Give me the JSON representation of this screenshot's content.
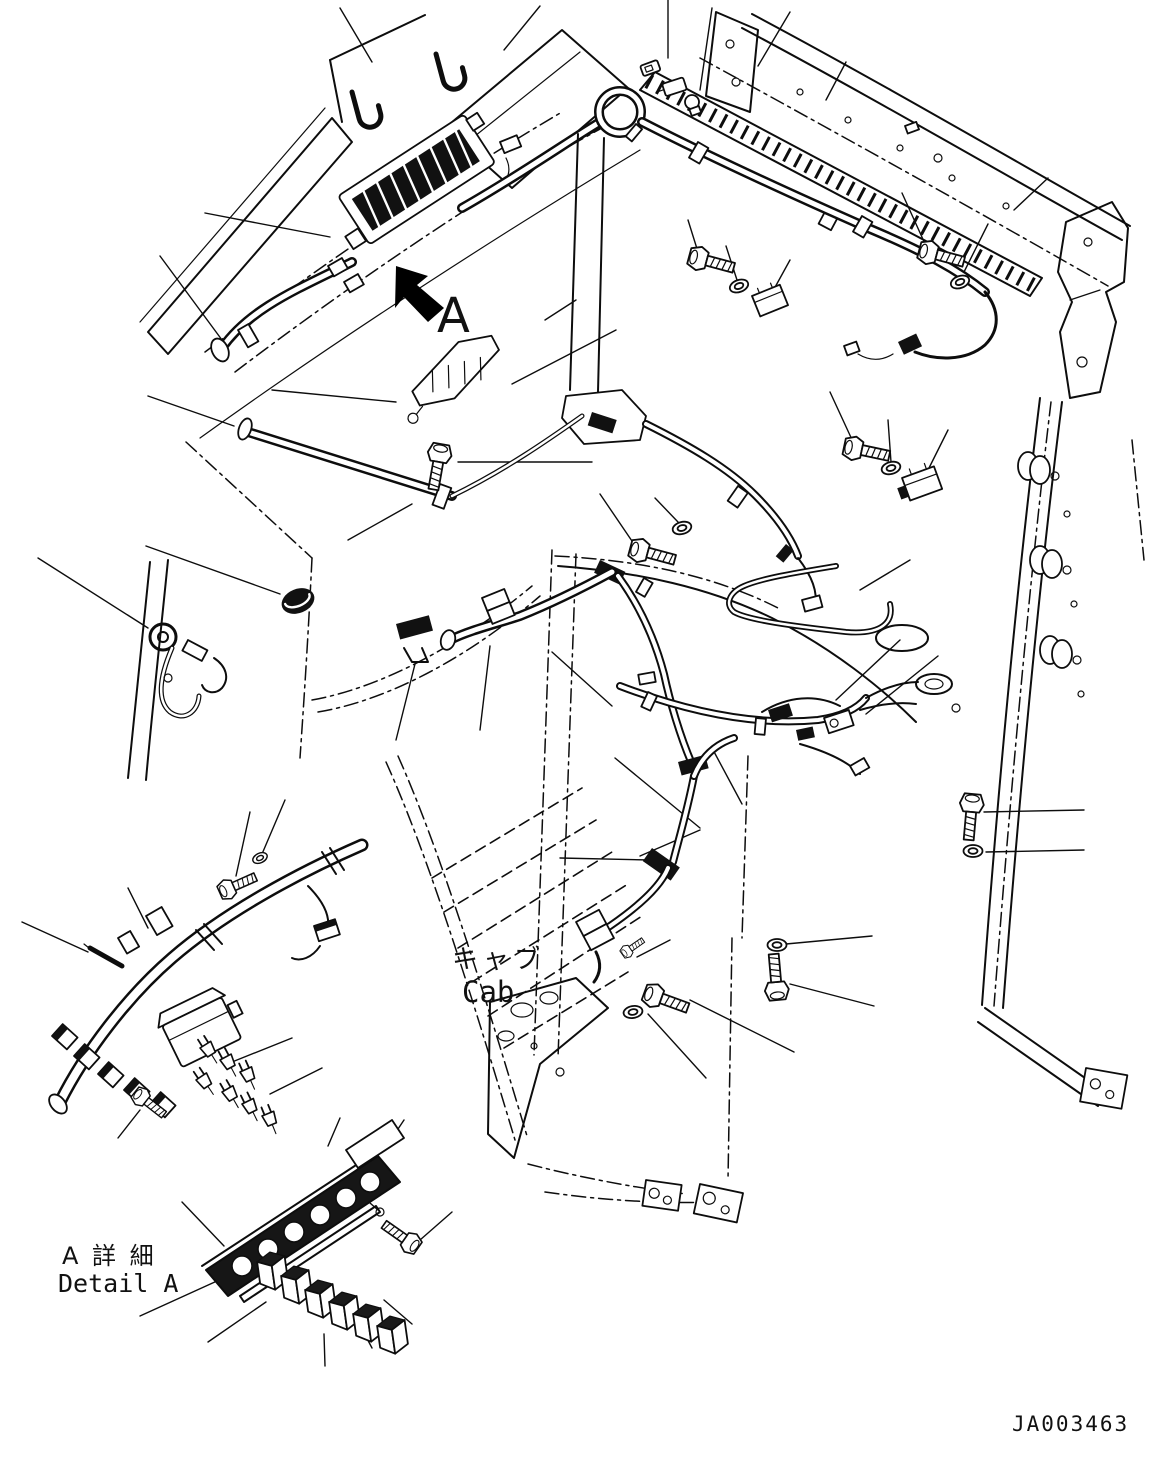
{
  "diagram": {
    "type": "exploded-parts-diagram",
    "subject": "cab wiring harness installation",
    "background_color": "#ffffff",
    "line_color": "#0d0d0d"
  },
  "labels": {
    "detail_marker": "A",
    "cab_label_jp": "キャブ",
    "cab_label_en": "Cab",
    "detail_title_jp": "A 詳 細",
    "detail_title_en": "Detail A",
    "drawing_number": "JA003463"
  },
  "icons": {
    "detail_arrow": "solid-arrow-up-left"
  }
}
